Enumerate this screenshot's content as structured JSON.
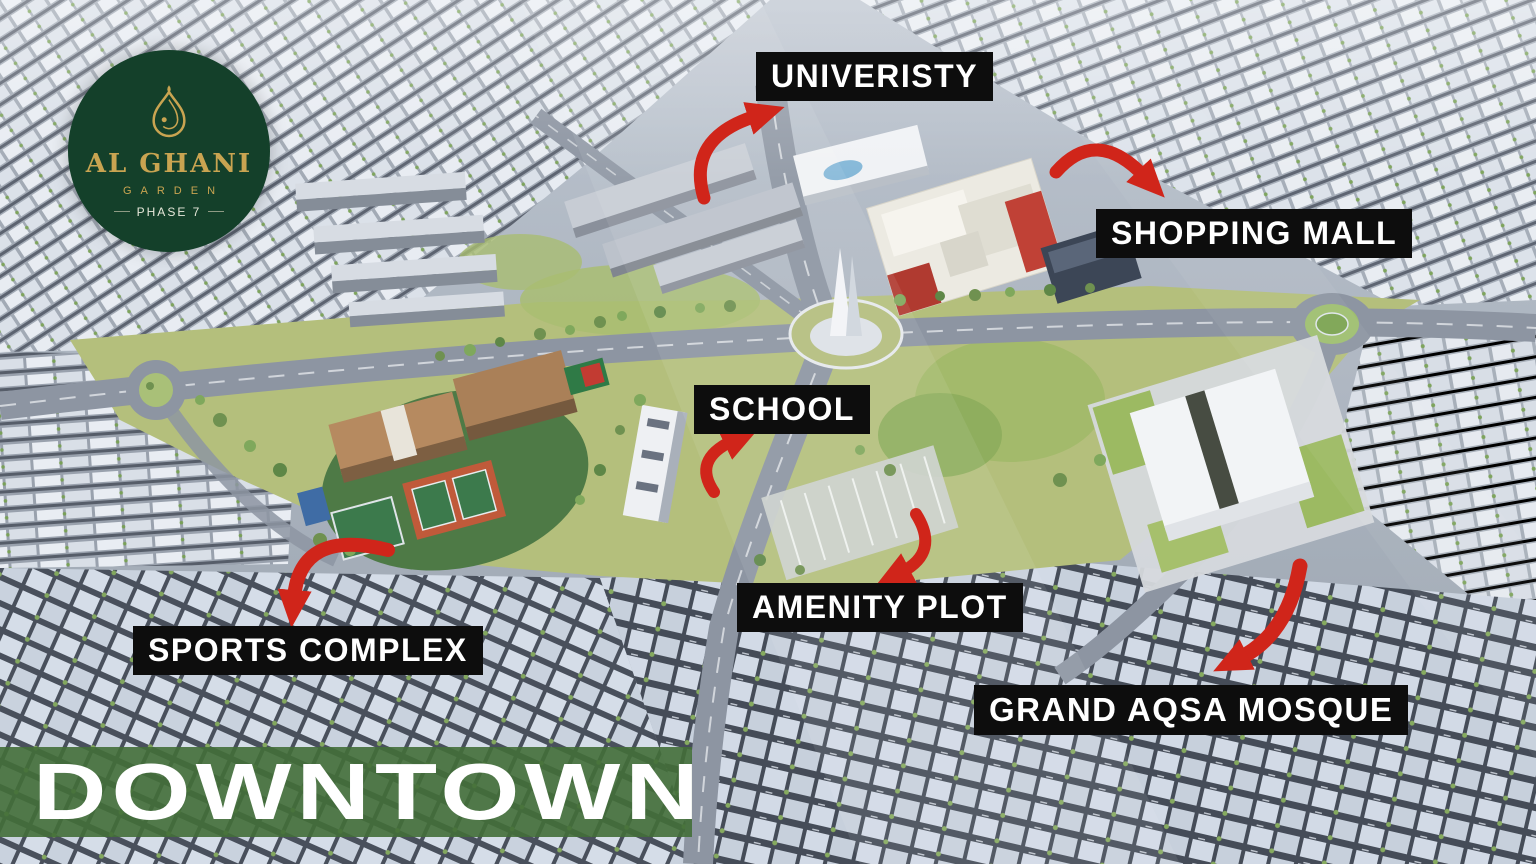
{
  "logo": {
    "title": "AL GHANI",
    "subtitle": "GARDEN",
    "phase": "PHASE 7"
  },
  "labels": [
    {
      "id": "univeristy",
      "text": "UNIVERISTY"
    },
    {
      "id": "shopping-mall",
      "text": "SHOPPING MALL"
    },
    {
      "id": "school",
      "text": "SCHOOL"
    },
    {
      "id": "amenity-plot",
      "text": "AMENITY PLOT"
    },
    {
      "id": "sports-complex",
      "text": "SPORTS COMPLEX"
    },
    {
      "id": "grand-aqsa-mosque",
      "text": "GRAND AQSA MOSQUE"
    }
  ],
  "banner": {
    "text": "DOWNTOWN"
  },
  "colors": {
    "label_background": "#0d0d0d",
    "label_text": "#ffffff",
    "arrow_red": "#d0251a",
    "banner_green": "#436e38",
    "logo_background": "#14402a",
    "logo_gold": "#c9a451",
    "logo_phase_text": "#e7e8da"
  }
}
